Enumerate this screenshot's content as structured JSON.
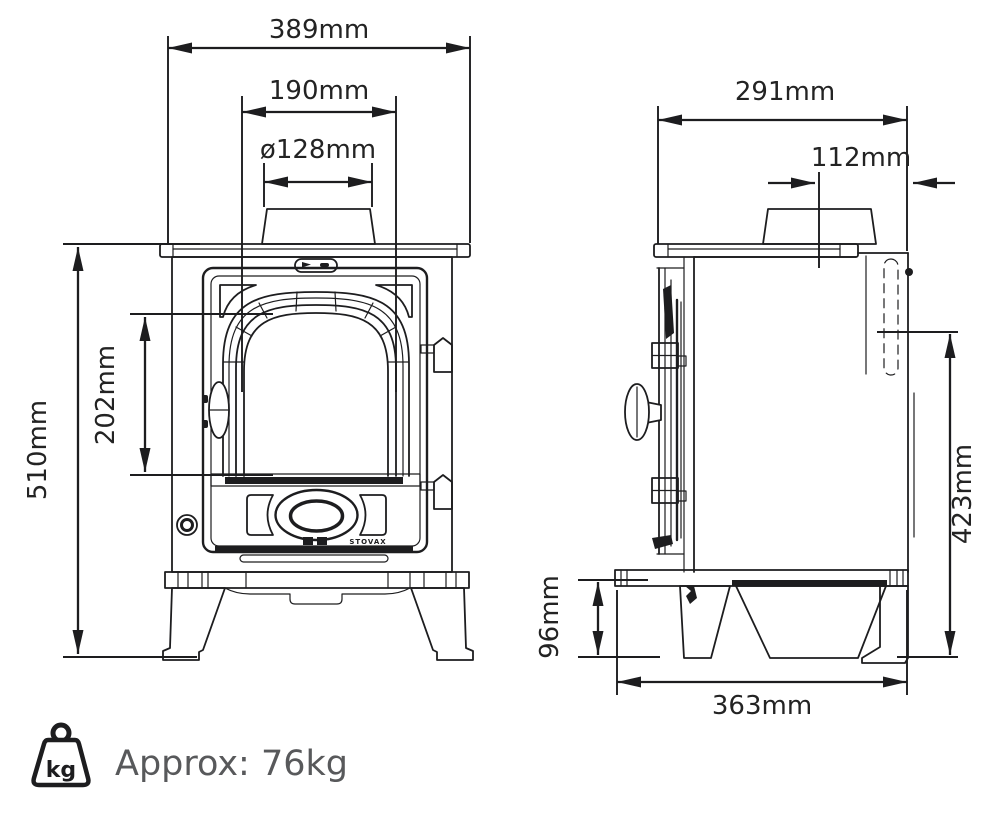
{
  "front_view": {
    "dims": {
      "overall_width": "389mm",
      "flue_spacing": "190mm",
      "flue_diameter": "ø128mm",
      "overall_height": "510mm",
      "window_height": "202mm"
    },
    "door_logo": "STOVAX"
  },
  "side_view": {
    "dims": {
      "overall_depth": "291mm",
      "flue_centre_to_rear": "112mm",
      "rear_flue_height": "423mm",
      "leg_clearance_height": "96mm",
      "base_depth": "363mm"
    }
  },
  "weight": {
    "label": "Approx: 76kg",
    "badge": "kg"
  },
  "colors": {
    "line": "#1d1d1f",
    "dim_text": "#232323",
    "weight_text": "#58595b",
    "background": "#ffffff"
  }
}
